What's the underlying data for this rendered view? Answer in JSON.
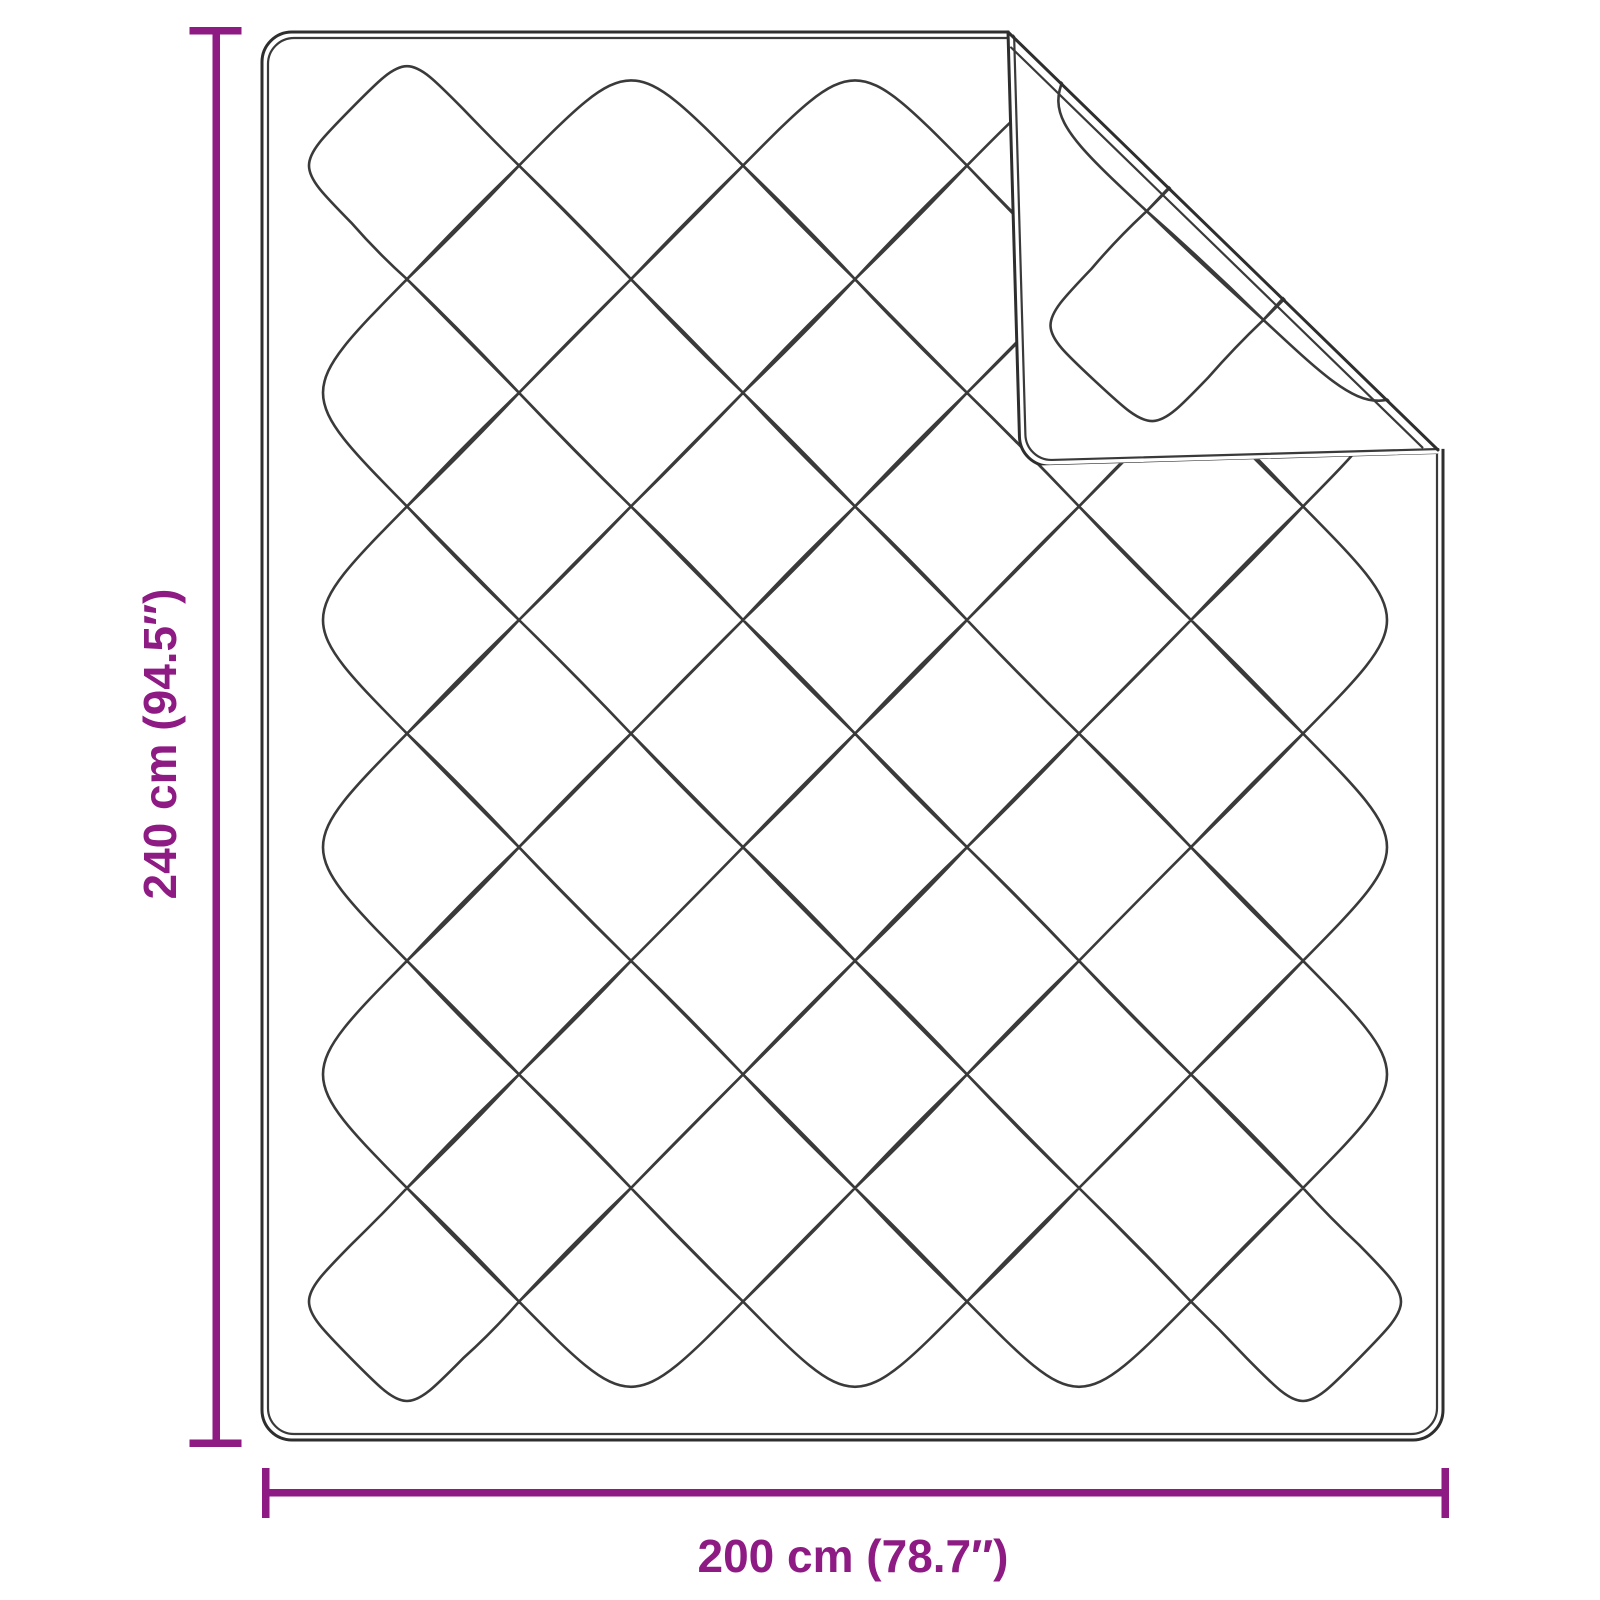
{
  "diagram": {
    "title": "Quilted blanket dimension diagram",
    "product": "quilted blanket with folded top-right corner",
    "height": {
      "label": "240 cm (94.5″)",
      "cm": 240,
      "inches": 94.5
    },
    "width": {
      "label": "200 cm (78.7″)",
      "cm": 200,
      "inches": 78.7
    },
    "colors": {
      "dimension_accent": "#8E1A84",
      "outline": "#2E2E2E",
      "quilt_line": "#3A3A3A",
      "background": "#FFFFFF"
    }
  }
}
